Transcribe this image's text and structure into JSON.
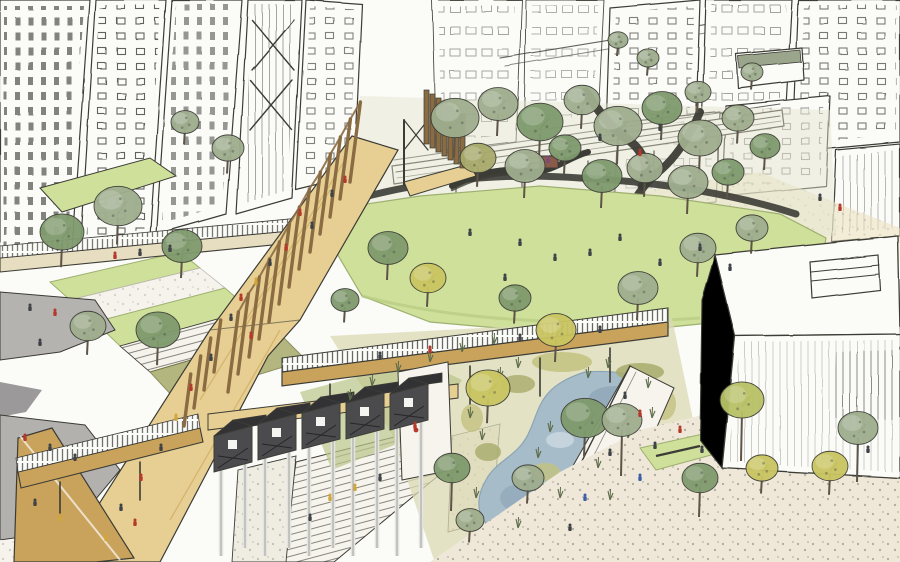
{
  "meta": {
    "title": "Hand-drawn urban park masterplan perspective sketch",
    "medium": "ink linework with watercolour wash",
    "scene_elements": [
      "sketched high-rise towers left",
      "sketched city blocks top right",
      "rail viaduct",
      "timber fin pavilion",
      "ochre pergola promenade",
      "terraced lawns and stairs",
      "central green lawn",
      "garden with stream and paths",
      "horizontal timber footbridge",
      "lower footbridge",
      "wetland pond with reeds",
      "boardwalk promenade",
      "dark gabled building on stilts",
      "white pavilion building right",
      "stippled plaza bottom right",
      "tiny pedestrians"
    ]
  },
  "palette": {
    "paper": "#fbfbf8",
    "ink": "#3c3c36",
    "inkSoft": "#6b6b63",
    "inkGreen": "#5c6b4a",
    "lawn": "#cfe09b",
    "lawnDeep": "#b7cb80",
    "sage": "#9fae8e",
    "green": "#7f9a6d",
    "olive": "#a8aa6b",
    "yellow": "#c9c561",
    "yellowgreen": "#b8c266",
    "cream": "#ece1bd",
    "walk": "#e7cf93",
    "ochreDeep": "#c9a35c",
    "timber": "#8a6b42",
    "gray": "#b5b3b0",
    "grayDark": "#9b999a",
    "dark": "#4b4b4d",
    "roof": "#323235",
    "stilt": "#e4e4e0",
    "water": "#a7bcc9",
    "waterDeep": "#8ba4b5",
    "wetland": "#dcd9b4",
    "shade": "#ededе8",
    "red": "#b5382c",
    "navy": "#3f4247",
    "blue": "#3e5fa5",
    "yellowFig": "#d2a63c",
    "purple": "#7c4a79"
  },
  "scene": {
    "trees": [
      [
        455,
        118,
        24,
        "sage"
      ],
      [
        498,
        104,
        20,
        "sage"
      ],
      [
        540,
        122,
        23,
        "green"
      ],
      [
        582,
        100,
        18,
        "sage"
      ],
      [
        618,
        126,
        24,
        "sage"
      ],
      [
        662,
        108,
        20,
        "green"
      ],
      [
        700,
        138,
        22,
        "sage"
      ],
      [
        738,
        118,
        16,
        "sage"
      ],
      [
        765,
        146,
        15,
        "green"
      ],
      [
        478,
        158,
        18,
        "olive"
      ],
      [
        525,
        166,
        20,
        "sage"
      ],
      [
        565,
        148,
        16,
        "green"
      ],
      [
        602,
        176,
        20,
        "green"
      ],
      [
        645,
        168,
        18,
        "sage"
      ],
      [
        688,
        182,
        20,
        "sage"
      ],
      [
        728,
        172,
        16,
        "green"
      ],
      [
        62,
        232,
        22,
        "green"
      ],
      [
        118,
        206,
        24,
        "sage"
      ],
      [
        182,
        246,
        20,
        "green"
      ],
      [
        88,
        326,
        18,
        "sage"
      ],
      [
        158,
        330,
        22,
        "green"
      ],
      [
        228,
        148,
        16,
        "sage"
      ],
      [
        185,
        122,
        14,
        "sage"
      ],
      [
        388,
        248,
        20,
        "green"
      ],
      [
        428,
        278,
        18,
        "yellow"
      ],
      [
        515,
        298,
        16,
        "green"
      ],
      [
        638,
        288,
        20,
        "sage"
      ],
      [
        698,
        248,
        18,
        "sage"
      ],
      [
        752,
        228,
        16,
        "sage"
      ],
      [
        345,
        300,
        14,
        "green"
      ],
      [
        488,
        388,
        22,
        "yellow"
      ],
      [
        556,
        330,
        20,
        "yellow"
      ],
      [
        585,
        418,
        24,
        "green"
      ],
      [
        452,
        468,
        18,
        "green",
        34
      ],
      [
        528,
        478,
        16,
        "sage"
      ],
      [
        470,
        520,
        14,
        "sage"
      ],
      [
        622,
        420,
        20,
        "sage",
        46
      ],
      [
        742,
        400,
        22,
        "yellowgreen",
        50
      ],
      [
        858,
        428,
        20,
        "sage",
        44
      ],
      [
        700,
        478,
        18,
        "green",
        30
      ],
      [
        762,
        468,
        16,
        "yellow"
      ],
      [
        830,
        466,
        18,
        "yellow"
      ],
      [
        698,
        92,
        13,
        "sage"
      ],
      [
        752,
        72,
        11,
        "sage"
      ],
      [
        648,
        58,
        11,
        "sage"
      ],
      [
        618,
        40,
        10,
        "sage"
      ]
    ],
    "figures": [
      [
        332,
        196,
        "navy"
      ],
      [
        345,
        182,
        "red"
      ],
      [
        300,
        215,
        "red"
      ],
      [
        312,
        228,
        "navy"
      ],
      [
        286,
        250,
        "red"
      ],
      [
        270,
        265,
        "navy"
      ],
      [
        256,
        284,
        "yellowFig"
      ],
      [
        241,
        300,
        "red"
      ],
      [
        231,
        320,
        "navy"
      ],
      [
        251,
        338,
        "red"
      ],
      [
        211,
        360,
        "navy"
      ],
      [
        191,
        390,
        "red"
      ],
      [
        176,
        420,
        "yellowFig"
      ],
      [
        161,
        450,
        "navy"
      ],
      [
        141,
        480,
        "red"
      ],
      [
        121,
        510,
        "navy"
      ],
      [
        106,
        540,
        "yellowFig"
      ],
      [
        135,
        525,
        "red"
      ],
      [
        115,
        258,
        "red"
      ],
      [
        140,
        255,
        "navy"
      ],
      [
        170,
        251,
        "navy"
      ],
      [
        30,
        310,
        "navy"
      ],
      [
        55,
        315,
        "red"
      ],
      [
        40,
        345,
        "navy"
      ],
      [
        25,
        440,
        "red"
      ],
      [
        50,
        450,
        "navy"
      ],
      [
        75,
        460,
        "navy"
      ],
      [
        35,
        505,
        "navy"
      ],
      [
        60,
        520,
        "yellowFig"
      ],
      [
        380,
        358,
        "navy"
      ],
      [
        430,
        352,
        "red"
      ],
      [
        520,
        340,
        "navy"
      ],
      [
        600,
        332,
        "navy"
      ],
      [
        470,
        235,
        "navy"
      ],
      [
        520,
        245,
        "navy"
      ],
      [
        555,
        260,
        "navy"
      ],
      [
        590,
        255,
        "navy"
      ],
      [
        620,
        240,
        "navy"
      ],
      [
        660,
        265,
        "navy"
      ],
      [
        700,
        250,
        "navy"
      ],
      [
        730,
        270,
        "navy"
      ],
      [
        505,
        280,
        "navy"
      ],
      [
        625,
        398,
        "navy"
      ],
      [
        640,
        416,
        "red"
      ],
      [
        610,
        455,
        "navy"
      ],
      [
        585,
        500,
        "blue"
      ],
      [
        570,
        530,
        "navy"
      ],
      [
        655,
        448,
        "navy"
      ],
      [
        680,
        432,
        "red"
      ],
      [
        702,
        452,
        "navy"
      ],
      [
        640,
        480,
        "blue"
      ],
      [
        868,
        452,
        "navy"
      ],
      [
        330,
        500,
        "yellowFig"
      ],
      [
        355,
        490,
        "yellowFig"
      ],
      [
        310,
        520,
        "navy"
      ],
      [
        380,
        480,
        "navy"
      ],
      [
        600,
        140,
        "navy"
      ],
      [
        640,
        155,
        "red"
      ],
      [
        660,
        130,
        "navy"
      ],
      [
        820,
        200,
        "navy"
      ],
      [
        840,
        210,
        "red"
      ],
      [
        415,
        428,
        "red"
      ],
      [
        548,
        162,
        "purple"
      ]
    ],
    "pergola_posts": [
      [
        350,
        182,
        80
      ],
      [
        340,
        199,
        80
      ],
      [
        330,
        217,
        80
      ],
      [
        320,
        234,
        80
      ],
      [
        310,
        252,
        80
      ],
      [
        299,
        269,
        80
      ],
      [
        289,
        287,
        80
      ],
      [
        279,
        304,
        80
      ],
      [
        269,
        322,
        80
      ],
      [
        259,
        339,
        80
      ],
      [
        249,
        357,
        80
      ],
      [
        238,
        374,
        80
      ],
      [
        228,
        392,
        80
      ],
      [
        214,
        372,
        52
      ],
      [
        204,
        390,
        52
      ],
      [
        194,
        408,
        52
      ],
      [
        184,
        426,
        52
      ]
    ],
    "timber_fins": [
      [
        424,
        90
      ],
      [
        430,
        94
      ],
      [
        436,
        98
      ],
      [
        442,
        102
      ],
      [
        448,
        106
      ],
      [
        454,
        110
      ],
      [
        460,
        114
      ]
    ],
    "reeds": [
      [
        470,
        418
      ],
      [
        482,
        440
      ],
      [
        500,
        378
      ],
      [
        518,
        368
      ],
      [
        608,
        368
      ],
      [
        648,
        388
      ],
      [
        628,
        438
      ],
      [
        598,
        468
      ],
      [
        560,
        498
      ],
      [
        538,
        458
      ],
      [
        476,
        498
      ],
      [
        518,
        528
      ],
      [
        652,
        418
      ],
      [
        588,
        378
      ],
      [
        550,
        432
      ],
      [
        610,
        500
      ],
      [
        350,
        400
      ],
      [
        372,
        386
      ],
      [
        398,
        372
      ],
      [
        430,
        362
      ],
      [
        462,
        352
      ],
      [
        494,
        344
      ]
    ]
  }
}
